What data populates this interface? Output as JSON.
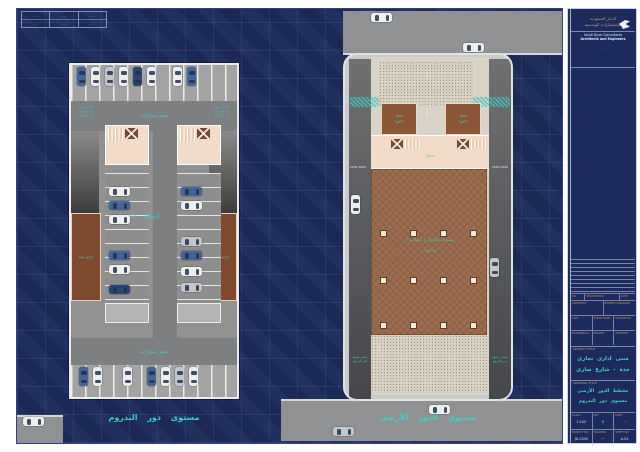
{
  "legend": {
    "cols": [
      {
        "top": "· ·· ·",
        "bot": "·····"
      },
      {
        "top": "····",
        "bot": "······"
      },
      {
        "top": "····· ·",
        "bot": "······"
      }
    ]
  },
  "basement": {
    "aisle_top": "ممر سيارات",
    "aisle_bottom": "ممر سيارات",
    "waiting": "انتظار سيارات",
    "tank": "خزان مياه",
    "ramp_down": "منحدر هبوط\nمن الأرضى\nالى البدروم",
    "ramp_up": "منحدر صعود\nمن البدروم\nالى الأرضى",
    "caption": "مستوى دور البدروم"
  },
  "ground": {
    "shop": "محل",
    "shop_area": "٣٦م٢",
    "entrance": "مدخل",
    "hall": "مساحة للايجار ( محلات )",
    "hall_area": "٣٦٥م٢",
    "ramp_down": "منحدر هبوط\nالى البدروم",
    "ramp_up": "منحدر صعود\nمن البدروم",
    "caption": "مستوى الدور الأرضى",
    "dims": {
      "left": "2200  3600",
      "right": "3600  2200",
      "v1": "7500",
      "v2": "3000",
      "v3": "1800"
    }
  },
  "titleblock": {
    "company_ar1": "الديار السعودية",
    "company_ar2": "للإستشارات الهندسية",
    "company_en1": "Saudi Diyar Consultants",
    "company_en2": "Architects and Engineers",
    "address1": "· · · · · · · · · · · ·",
    "address2": "· · · · · · · · · · · ·",
    "rev_no": "NO.",
    "rev_desc": "DESCRIPTION",
    "rev_date": "DATE",
    "stamp1a": "ARCHITECT",
    "stamp1b": "PROJECT MANAGER",
    "stamp2a": "CIVIL",
    "stamp2b": "STRUCTURAL",
    "stamp2c": "ELECTRICAL",
    "stamp3a": "MECHANICAL",
    "stamp3b": "DRAWN",
    "stamp3c": "CHECKED",
    "project_title_label": "PROJECT TITLE",
    "project_l1": "مبنى ادارى تجارى",
    "project_l2": "جدة - شارع صارى",
    "drawing_title_label": "DRAWING TITLE",
    "drawing_l1": "مخطط الدور الأرضى",
    "drawing_l2": "مستوى دور البدروم",
    "meta": {
      "scale_label": "SCALE",
      "scale": "1:100",
      "ref_label": "REF.",
      "ref": "0",
      "date_label": "DATE",
      "date": "····",
      "proj_label": "PROJECT NO.",
      "proj": "JD-2043",
      "drawn_label": "DRAWING",
      "drawn": "····",
      "sheet_label": "SHEET NO.",
      "sheet": "A-01"
    }
  },
  "colors": {
    "teal": "#40c8c0",
    "tan": "#c59a5f",
    "navy": "#20305f"
  }
}
